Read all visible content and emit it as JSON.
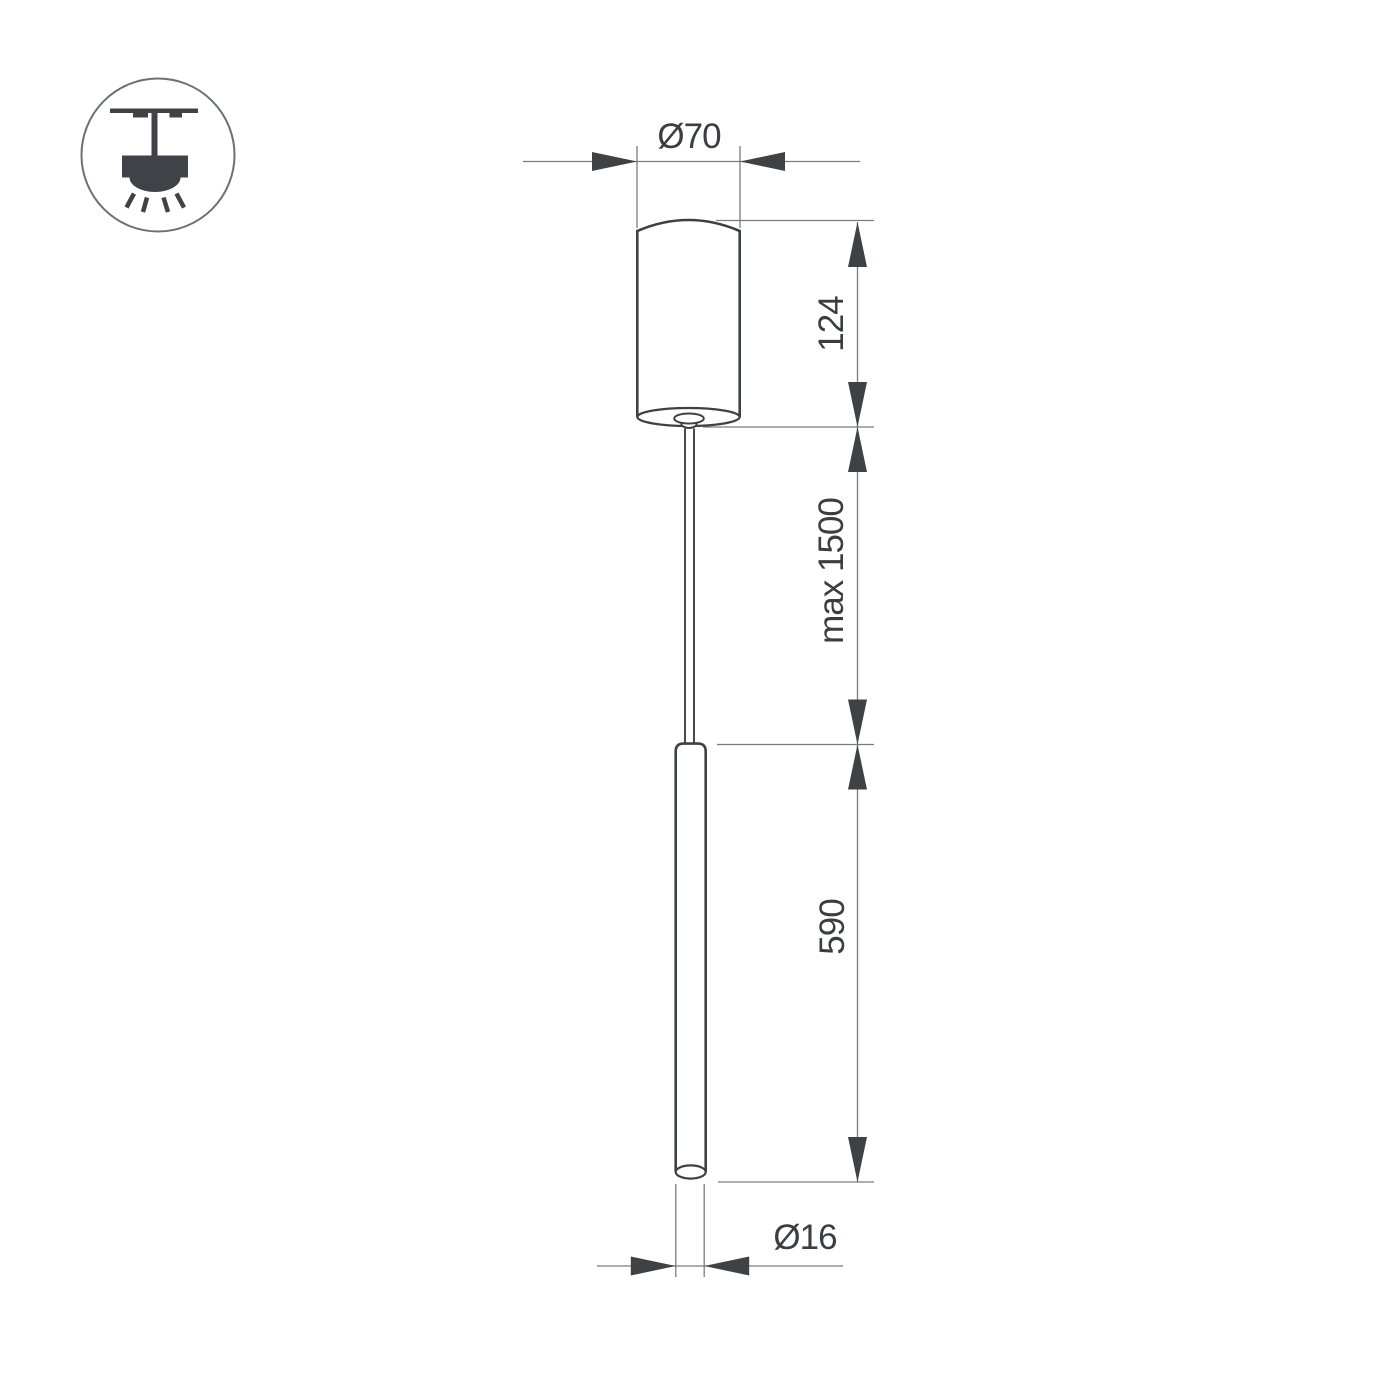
{
  "page": {
    "background": "#ffffff",
    "description_labels_only": true
  },
  "colors": {
    "object_line": "#3d4145",
    "dimension_line": "#797c7f",
    "arrow": "#3e4245",
    "text": "#3a3e42",
    "icon": "#3f4246",
    "icon_circle": "#6d7073",
    "fill": "#ffffff"
  },
  "icon": {
    "name": "ceiling-pendant-mount",
    "shapes": [
      "ceiling-line",
      "mount-stem",
      "lamp-body",
      "light-dome",
      "light-rays"
    ]
  },
  "labels": {
    "canopy_diameter": "Ø70",
    "canopy_height": "124",
    "suspension_length": "max 1500",
    "tube_length": "590",
    "tube_diameter": "Ø16"
  }
}
